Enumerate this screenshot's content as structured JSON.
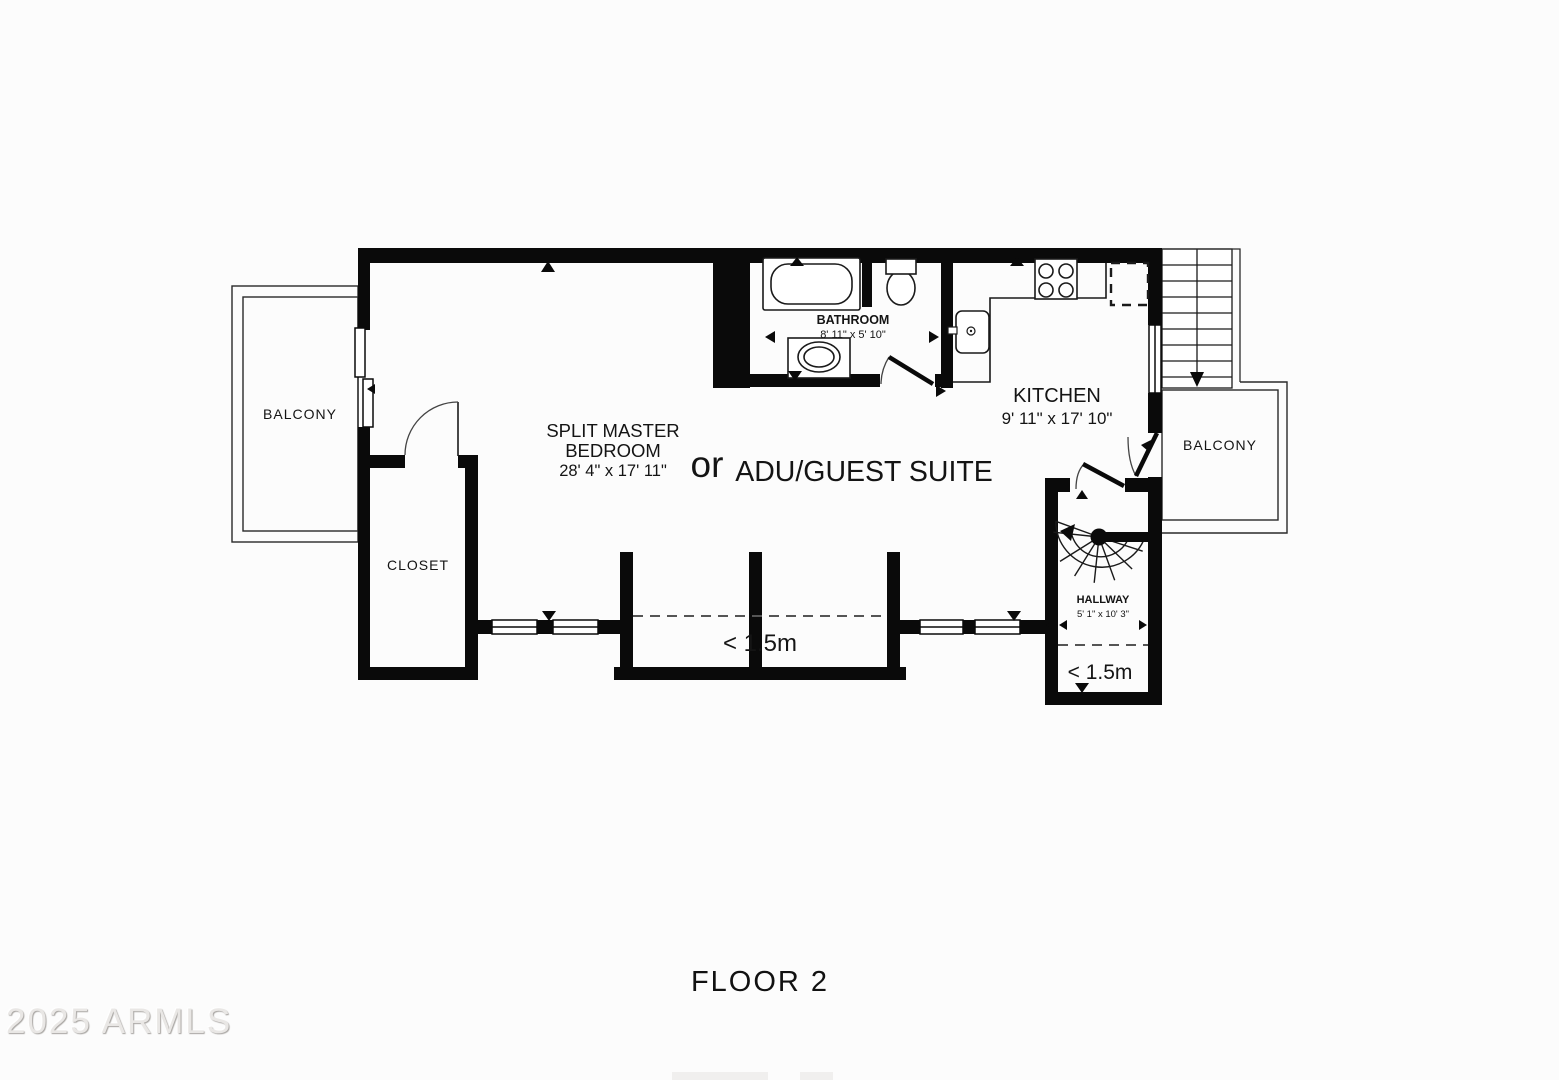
{
  "title": {
    "floor_label": "FLOOR 2"
  },
  "watermark": {
    "text": "2025 ARMLS"
  },
  "rooms": {
    "balcony_left": {
      "label": "BALCONY"
    },
    "balcony_right": {
      "label": "BALCONY"
    },
    "closet": {
      "label": "CLOSET"
    },
    "bedroom": {
      "line1": "SPLIT MASTER",
      "line2": "BEDROOM",
      "dims": "28' 4\" x 17' 11\"",
      "conjunction": "or",
      "alt_name": "ADU/GUEST SUITE"
    },
    "bathroom": {
      "label": "BATHROOM",
      "dims": "8' 11\" x 5' 10\""
    },
    "kitchen": {
      "label": "KITCHEN",
      "dims": "9' 11\" x 17' 10\""
    },
    "hallway": {
      "label": "HALLWAY",
      "dims": "5' 1\" x 10' 3\"",
      "clearance": "< 1.5m"
    },
    "bay": {
      "clearance": "< 1.5m"
    }
  },
  "colors": {
    "wall": "#0a0a0a",
    "background": "#fcfcfc",
    "thin_line": "#1a1a1a",
    "dash": "#555555"
  }
}
